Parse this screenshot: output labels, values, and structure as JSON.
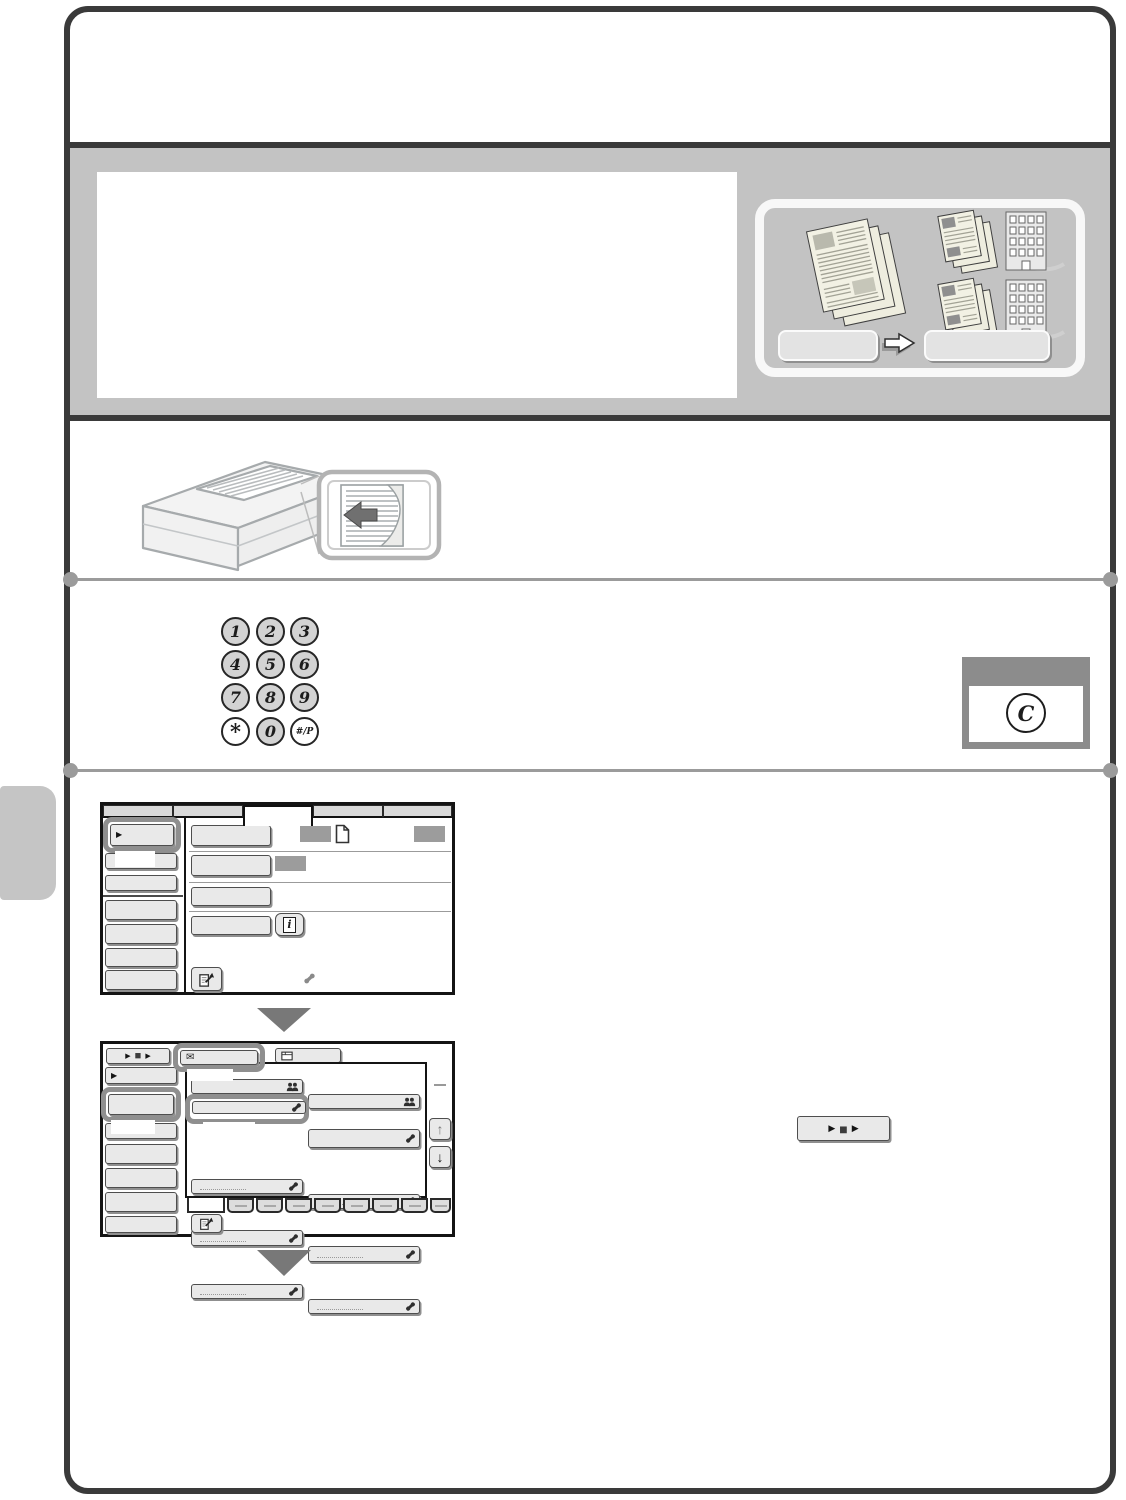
{
  "palette": {
    "frame_border": "#3a3a3a",
    "band_gray": "#c3c3c3",
    "highlight_outline": "#8f8f8f",
    "key_fill": "#d3d3d3",
    "screen_button_face": "#e9e9e9",
    "redacted_text_block": "#9c9c9c",
    "divider_gray": "#9b9b9b",
    "step_arrow_gray": "#787878"
  },
  "icons": {
    "sidebar_arrow": "▶",
    "job_play": "▶",
    "job_stop": "■",
    "envelope": "✉",
    "scroll_up": "↑",
    "scroll_down": "↓",
    "info": "i"
  },
  "keypad": {
    "keys": [
      {
        "label": "1",
        "filled": true
      },
      {
        "label": "2",
        "filled": true
      },
      {
        "label": "3",
        "filled": true
      },
      {
        "label": "4",
        "filled": true
      },
      {
        "label": "5",
        "filled": true
      },
      {
        "label": "6",
        "filled": true
      },
      {
        "label": "7",
        "filled": true
      },
      {
        "label": "8",
        "filled": true
      },
      {
        "label": "9",
        "filled": true
      },
      {
        "label": "*",
        "filled": false
      },
      {
        "label": "0",
        "filled": true
      },
      {
        "label": "#/P",
        "filled": false
      }
    ]
  },
  "clear_key": {
    "label": "C"
  }
}
